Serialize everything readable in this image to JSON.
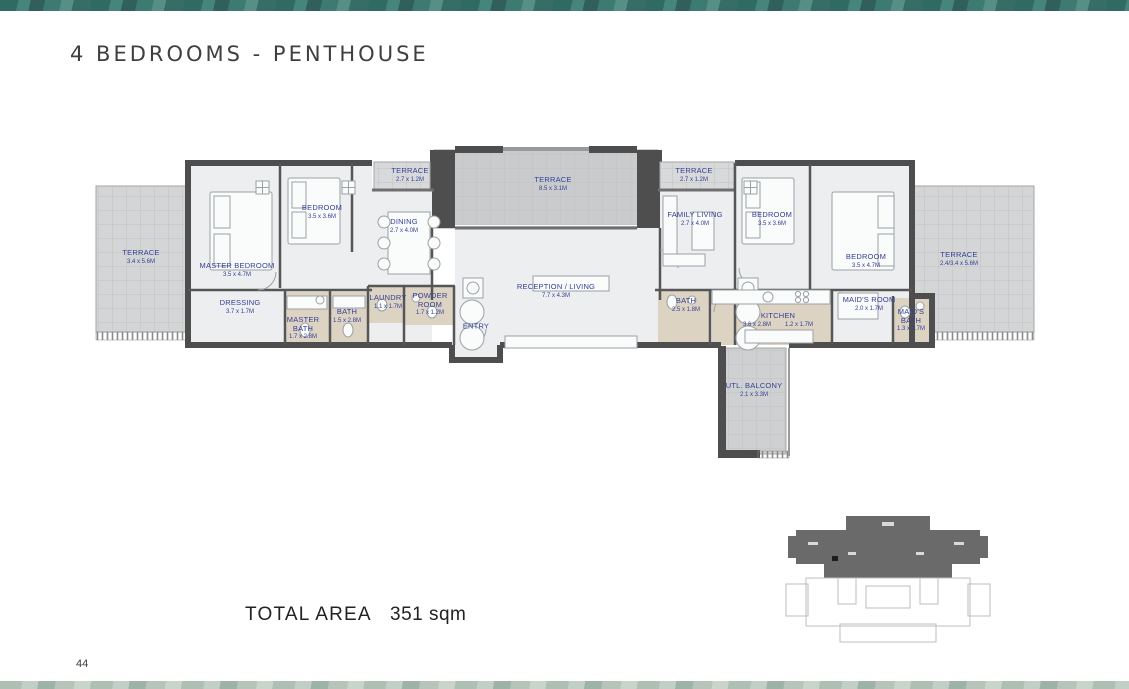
{
  "page": {
    "title": "4 BEDROOMS - PENTHOUSE",
    "total_area_label": "TOTAL AREA",
    "total_area_value": "351 sqm",
    "page_number": "44"
  },
  "colors": {
    "band_teal": "#3d7a72",
    "band_bottom": "#b7c4ba",
    "label_blue": "#333f96",
    "wall_dark": "#4e4e4e",
    "floor_light": "#edeef0",
    "wet_area_beige": "#ddd3c3",
    "terrace_gray": "#d4d5d6"
  },
  "floorplan": {
    "rooms": [
      {
        "id": "terrace-left",
        "name": "TERRACE",
        "dims": "3.4 x 5.6M"
      },
      {
        "id": "master-bedroom",
        "name": "MASTER BEDROOM",
        "dims": "3.5 x 4.7M"
      },
      {
        "id": "bedroom-left",
        "name": "BEDROOM",
        "dims": "3.5 x 3.6M"
      },
      {
        "id": "dressing",
        "name": "DRESSING",
        "dims": "3.7 x 1.7M"
      },
      {
        "id": "master-bath",
        "name": "MASTER\nBATH",
        "dims": "1.7 x 2.8M"
      },
      {
        "id": "bath-left",
        "name": "BATH",
        "dims": "1.5 x 2.8M"
      },
      {
        "id": "laundry",
        "name": "LAUNDRY",
        "dims": "1.1 x 1.7M"
      },
      {
        "id": "powder-room",
        "name": "POWDER\nROOM",
        "dims": "1.7 x 1.2M"
      },
      {
        "id": "terrace-top-left",
        "name": "TERRACE",
        "dims": "2.7 x 1.2M"
      },
      {
        "id": "dining",
        "name": "DINING",
        "dims": "2.7 x 4.0M"
      },
      {
        "id": "terrace-center",
        "name": "TERRACE",
        "dims": "8.5 x 3.1M"
      },
      {
        "id": "reception-living",
        "name": "RECEPTION / LIVING",
        "dims": "7.7 x 4.3M"
      },
      {
        "id": "entry",
        "name": "ENTRY",
        "dims": ""
      },
      {
        "id": "terrace-top-right",
        "name": "TERRACE",
        "dims": "2.7 x 1.2M"
      },
      {
        "id": "family-living",
        "name": "FAMILY LIVING",
        "dims": "2.7 x 4.0M"
      },
      {
        "id": "bedroom-right-1",
        "name": "BEDROOM",
        "dims": "3.5 x 3.6M"
      },
      {
        "id": "bedroom-right-2",
        "name": "BEDROOM",
        "dims": "3.5 x 4.7M"
      },
      {
        "id": "bath-right",
        "name": "BATH",
        "dims": "2.5 x 1.8M"
      },
      {
        "id": "kitchen",
        "name": "KITCHEN",
        "dims": "3.6 x 2.8M",
        "dims2": "1.2 x 1.7M"
      },
      {
        "id": "maids-room",
        "name": "MAID'S ROOM",
        "dims": "2.0 x 1.7M"
      },
      {
        "id": "maids-bath",
        "name": "MAID'S\nBATH",
        "dims": "1.3 x 1.7M"
      },
      {
        "id": "terrace-right",
        "name": "TERRACE",
        "dims": "2.4/3.4 x 5.6M"
      },
      {
        "id": "utl-balcony",
        "name": "UTL. BALCONY",
        "dims": "2.1 x 3.3M"
      }
    ]
  }
}
